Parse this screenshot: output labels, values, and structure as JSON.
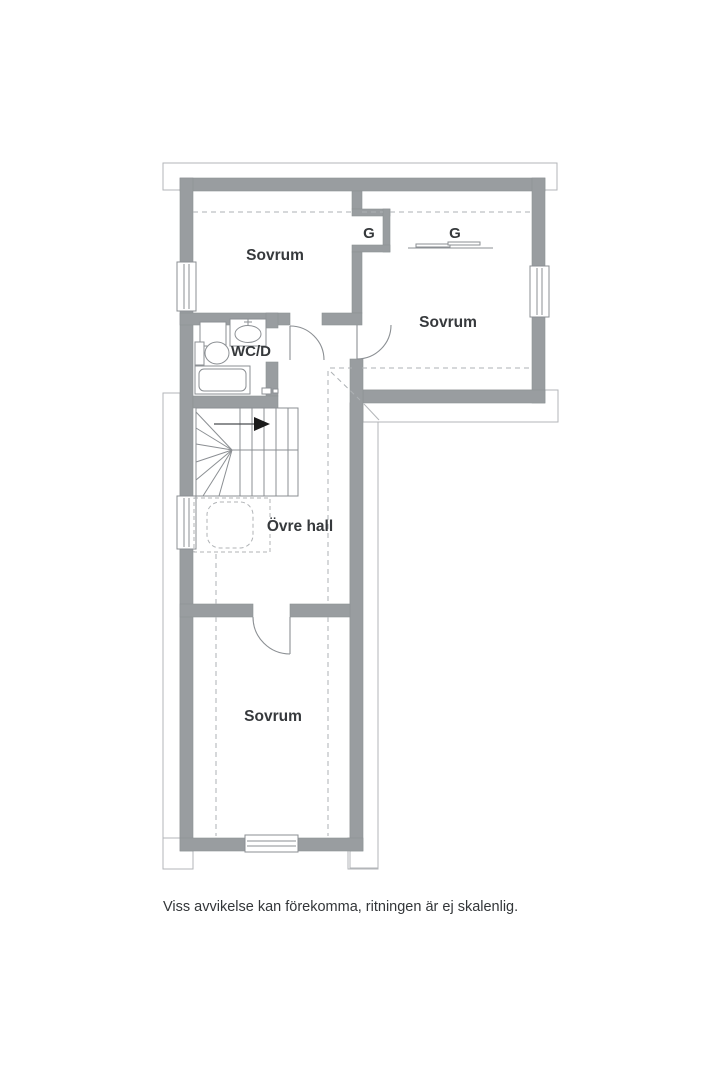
{
  "floor_plan": {
    "labels": {
      "bedroom_upper_left": "Sovrum",
      "bedroom_upper_right": "Sovrum",
      "bedroom_lower": "Sovrum",
      "upper_hall": "Övre hall",
      "wc_shower": "WC/D",
      "wardrobe_left": "G",
      "wardrobe_right": "G"
    },
    "caption": "Viss avvikelse kan förekomma, ritningen är ej skalenlig.",
    "colors": {
      "wall": "#999da0",
      "thin_line": "#8b8f93",
      "ground_floor_outline": "#b3b6b9",
      "dashed_ceiling_line": "#adb1b4",
      "text": "#36393c",
      "background": "#ffffff",
      "stair_arrow": "#1a1a1a"
    }
  }
}
